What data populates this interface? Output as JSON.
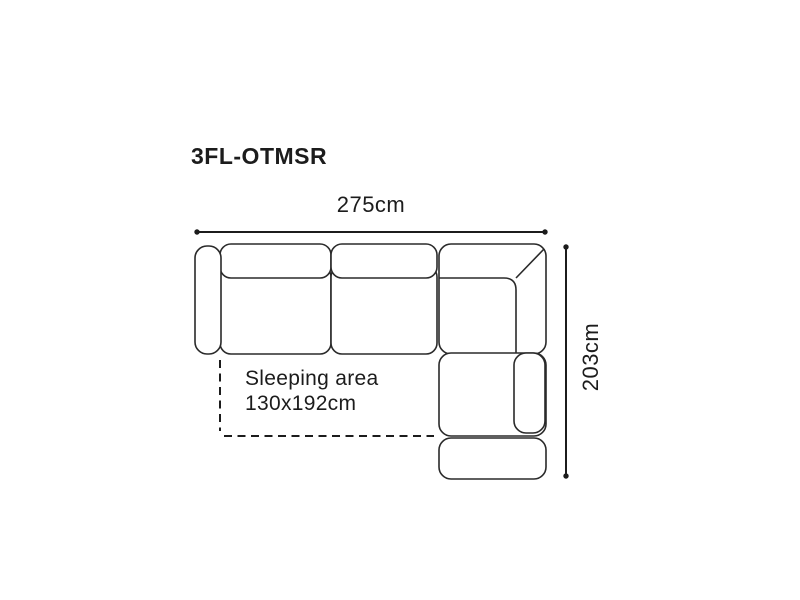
{
  "diagram": {
    "product_code": "3FL-OTMSR",
    "width_label": "275cm",
    "height_label": "203cm",
    "sleeping_area": {
      "line1": "Sleeping area",
      "line2": "130x192cm"
    },
    "colors": {
      "outline": "#2a2a2a",
      "dimension": "#1c1c1c",
      "text": "#1c1c1c",
      "background": "#ffffff"
    }
  }
}
